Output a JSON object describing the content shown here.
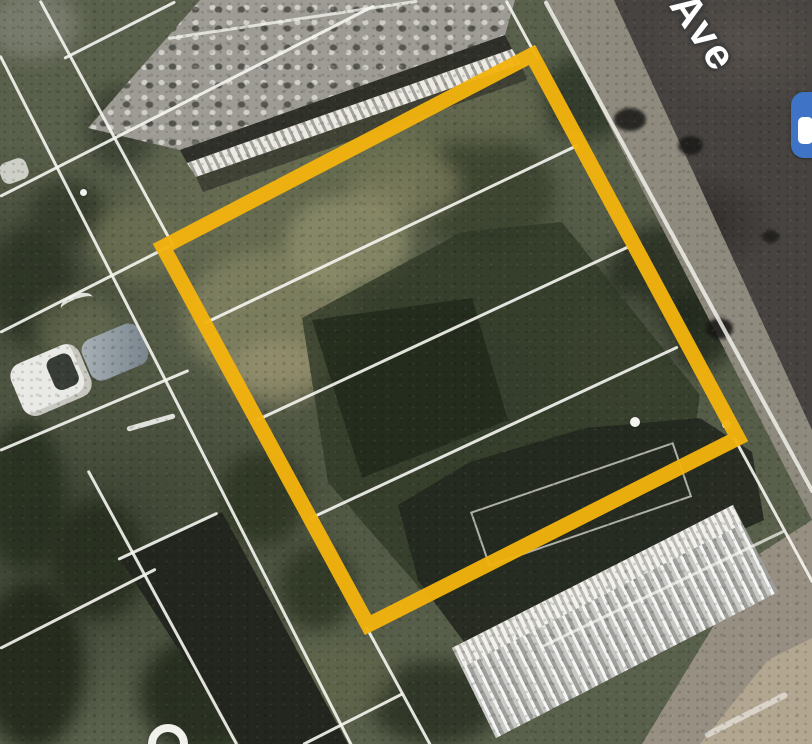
{
  "map_view": {
    "kind": "satellite-imagery",
    "street_label": "Ave",
    "highlight": {
      "shape": "rotated-rectangle",
      "points": "163,247 532,55 738,438 368,625",
      "color": "#F2B30E",
      "stroke_width": 15
    },
    "poi_chip": {
      "color": "#3E73C6",
      "glyph_color": "#FFFFFF"
    },
    "street_label_fragment_visible": true
  }
}
